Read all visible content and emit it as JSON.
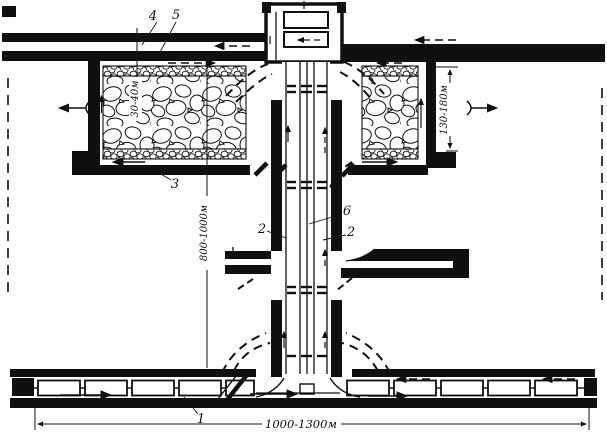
{
  "figure": {
    "title": "panel-mining-layout-scheme",
    "callouts": {
      "train": "1",
      "incline_left": "2",
      "incline_right": "2",
      "stope_drift": "3",
      "vent_drift": "4",
      "haulage_drift_top": "5",
      "conveyor": "6"
    },
    "dimensions": {
      "strip_width": "30-40м",
      "stope_length": "130-180м",
      "panel_length": "800-1000м",
      "panel_width": "1000-1300м"
    },
    "colors": {
      "ink": "#101010",
      "paper": "#ffffff"
    }
  }
}
